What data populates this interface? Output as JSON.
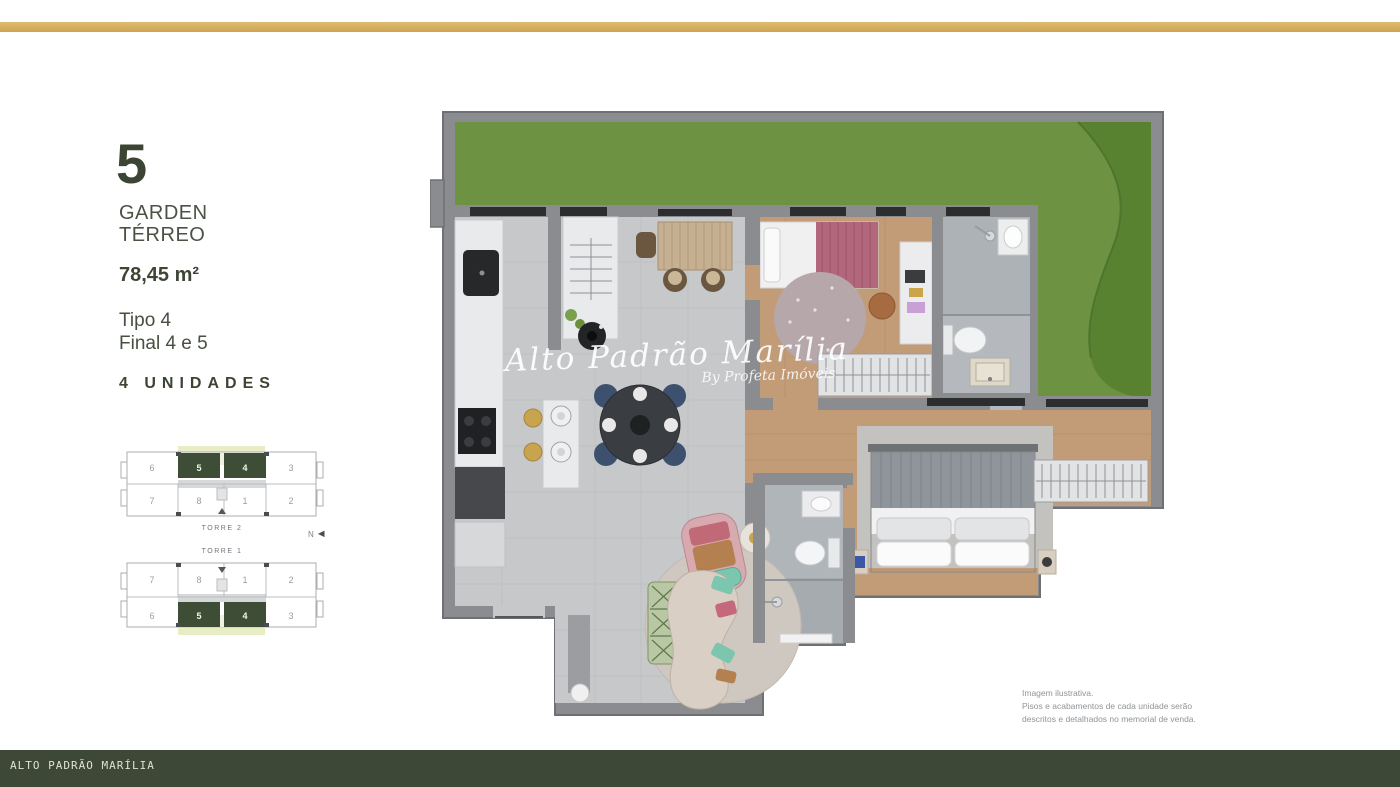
{
  "top_bar": {
    "color": "#d3ae5e"
  },
  "bottom_bar": {
    "text": "ALTO PADRÃO MARÍLIA",
    "color": "#3e4837"
  },
  "unit_info": {
    "number": "5",
    "type_line1": "GARDEN",
    "type_line2": "TÉRREO",
    "area": "78,45 m²",
    "tipo": "Tipo 4",
    "final": "Final 4 e 5",
    "units_count": "4 UNIDADES"
  },
  "key_plans": [
    {
      "name": "TORRE 2",
      "top_row": [
        "6",
        "5",
        "4",
        "3"
      ],
      "bottom_row": [
        "7",
        "8",
        "1",
        "2"
      ],
      "highlighted_units": [
        "5",
        "4"
      ]
    },
    {
      "name": "TORRE 1",
      "top_row": [
        "7",
        "8",
        "1",
        "2"
      ],
      "bottom_row": [
        "6",
        "5",
        "4",
        "3"
      ],
      "highlighted_units": [
        "5",
        "4"
      ]
    }
  ],
  "compass": {
    "label": "N"
  },
  "watermark": {
    "line1": "Alto Padrão Marília",
    "line2": "By Profeta Imóveis"
  },
  "disclaimer": {
    "line1": "Imagem ilustrativa.",
    "line2": "Pisos e acabamentos de cada unidade serão",
    "line3": "descritos e detalhados no memorial de venda."
  },
  "colors": {
    "brand_gold": "#d3ae5e",
    "brand_olive": "#3e4837",
    "unit_highlight_green": "#3e4d35",
    "keyplan_highlight": "#e9edc4",
    "garden_green": "#6d9342",
    "garden_dark_green": "#55802f"
  }
}
